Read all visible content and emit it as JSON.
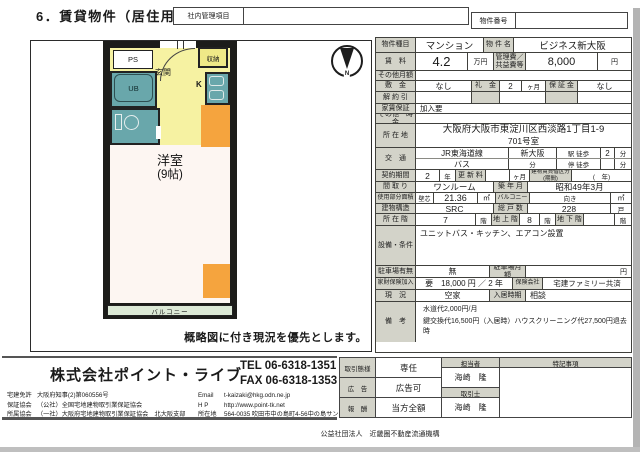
{
  "page": {
    "title": "6．賃貸物件（居住用）",
    "internal_box_label": "社内管理項目",
    "property_no_label": "物件番号",
    "org_note": "公益社団法人　近畿圏不動産流通機構"
  },
  "colors": {
    "wall": "#1c1c1a",
    "entrance_yellow": "#f6f2a2",
    "bath_teal": "#69a7ab",
    "appliance_orange": "#f5a43e",
    "balcony_green": "#dce9d6",
    "label_gray": "#d3d3c9"
  },
  "floorplan": {
    "compass": "N",
    "ps": "PS",
    "ub": "UB",
    "entrance": "玄関",
    "storage": "収納",
    "kitchen": "K",
    "room_name": "洋室",
    "room_size": "(9帖)",
    "balcony": "バルコニー",
    "caption": "概略図に付き現況を優先とします。"
  },
  "table": {
    "type": {
      "label": "物件種目",
      "value": "マンション"
    },
    "name": {
      "label": "物 件 名",
      "value": "ビジネス新大阪"
    },
    "rent": {
      "label": "賃　料",
      "value": "4.2",
      "unit": "万円"
    },
    "mgmt": {
      "label": "管理費／共益費等",
      "value": "8,000",
      "unit": "円"
    },
    "other_monthly": {
      "label": "その他月額"
    },
    "deposit": {
      "label": "敷　金",
      "value": "なし"
    },
    "key_money": {
      "label": "礼　金",
      "value": "2",
      "unit": "ヶ月"
    },
    "guarantee_money": {
      "label": "保 証 金",
      "value": "なし"
    },
    "cancellation": {
      "label": "解 約 引"
    },
    "rent_guarantee": {
      "label": "家賃保証",
      "value": "加入要"
    },
    "other_onetime": {
      "label": "その他一時金"
    },
    "address": {
      "label": "所 在 地",
      "line1": "大阪府大阪市東淀川区西淡路1丁目1-9",
      "line2": "701号室"
    },
    "access": {
      "label": "交　通",
      "rail": "JR東海道線",
      "station": "新大阪",
      "walk_label": "駅 徒歩",
      "walk_min": "2",
      "min_unit": "分",
      "bus": "バス",
      "bus_unit": "分",
      "stop_label": "停 徒歩",
      "stop_unit": "分"
    },
    "contract": {
      "label": "契約期間",
      "value": "2",
      "unit": "年",
      "renewal_label": "更 新 料",
      "renewal_unit": "ヶ月",
      "building_label": "建物賃貸借区分(期間)",
      "building_value": "(　年)"
    },
    "layout": {
      "label": "間 取 り",
      "value": "ワンルーム"
    },
    "built": {
      "label": "築 年 月",
      "value": "昭和49年3月"
    },
    "area": {
      "label": "使用部分面積",
      "sub": "壁芯",
      "value": "21.36",
      "unit": "㎡"
    },
    "balcony_col": {
      "label": "バルコニー",
      "facing": "向き",
      "unit": "㎡"
    },
    "structure": {
      "label": "建物構造",
      "value": "SRC"
    },
    "units": {
      "label": "総 戸 数",
      "value": "228",
      "unit": "戸"
    },
    "floor": {
      "label": "所 在 階",
      "value": "7",
      "unit": "階"
    },
    "floors_above": {
      "label": "地 上 階",
      "value": "8",
      "unit": "階"
    },
    "floors_below": {
      "label": "地 下 階",
      "value": "",
      "unit": "階"
    },
    "facilities": {
      "label": "設備・条件",
      "value": "ユニットバス・キッチン、エアコン設置"
    },
    "parking": {
      "label": "駐車場有無",
      "value": "無",
      "monthly_label": "駐車場月額",
      "monthly_unit": "円"
    },
    "insurance": {
      "label": "家財保険加入",
      "value": "要　18,000 円 ／ 2 年",
      "company_label": "保険会社",
      "company": "宅建ファミリー共済"
    },
    "status": {
      "label": "現　況",
      "value": "空家",
      "movein_label": "入居時期",
      "movein": "相談"
    },
    "remarks": {
      "label": "備　考",
      "line1": "水道代2,000円/月",
      "line2": "鍵交換代16,500円（入居時）ハウスクリーニング代27,500円退去時"
    }
  },
  "footer": {
    "company": "株式会社ポイント・ライブ",
    "tel": "TEL 06-6318-1351",
    "fax": "FAX 06-6318-1353",
    "license_label": "宅建免許",
    "license": "大阪府知事(2)第060556号",
    "guarantee_label": "保証協会",
    "guarantee": "（公社）全国宅地建物取引業保証協会",
    "assoc_label": "所属協会",
    "assoc": "（一社）大阪府宅地建物取引業保証協会　北大阪支部",
    "email_label": "Email",
    "email": "t-kaizaki@hkg.odn.ne.jp",
    "hp_label": "H P",
    "hp": "http://www.point-tk.net",
    "addr_label": "所在地",
    "addr": "564-0035 吹田市中の島町4-56中の島サンプラザ1階",
    "deal": {
      "label": "取引態様",
      "value": "専任"
    },
    "ad": {
      "label": "広　告",
      "value": "広告可"
    },
    "fee": {
      "label": "報　酬",
      "value": "当方全額"
    },
    "staff": {
      "label": "担当者",
      "value": "海崎　隆"
    },
    "agent": {
      "label": "取引士",
      "value": "海崎　隆"
    },
    "notes_label": "特記事項"
  }
}
